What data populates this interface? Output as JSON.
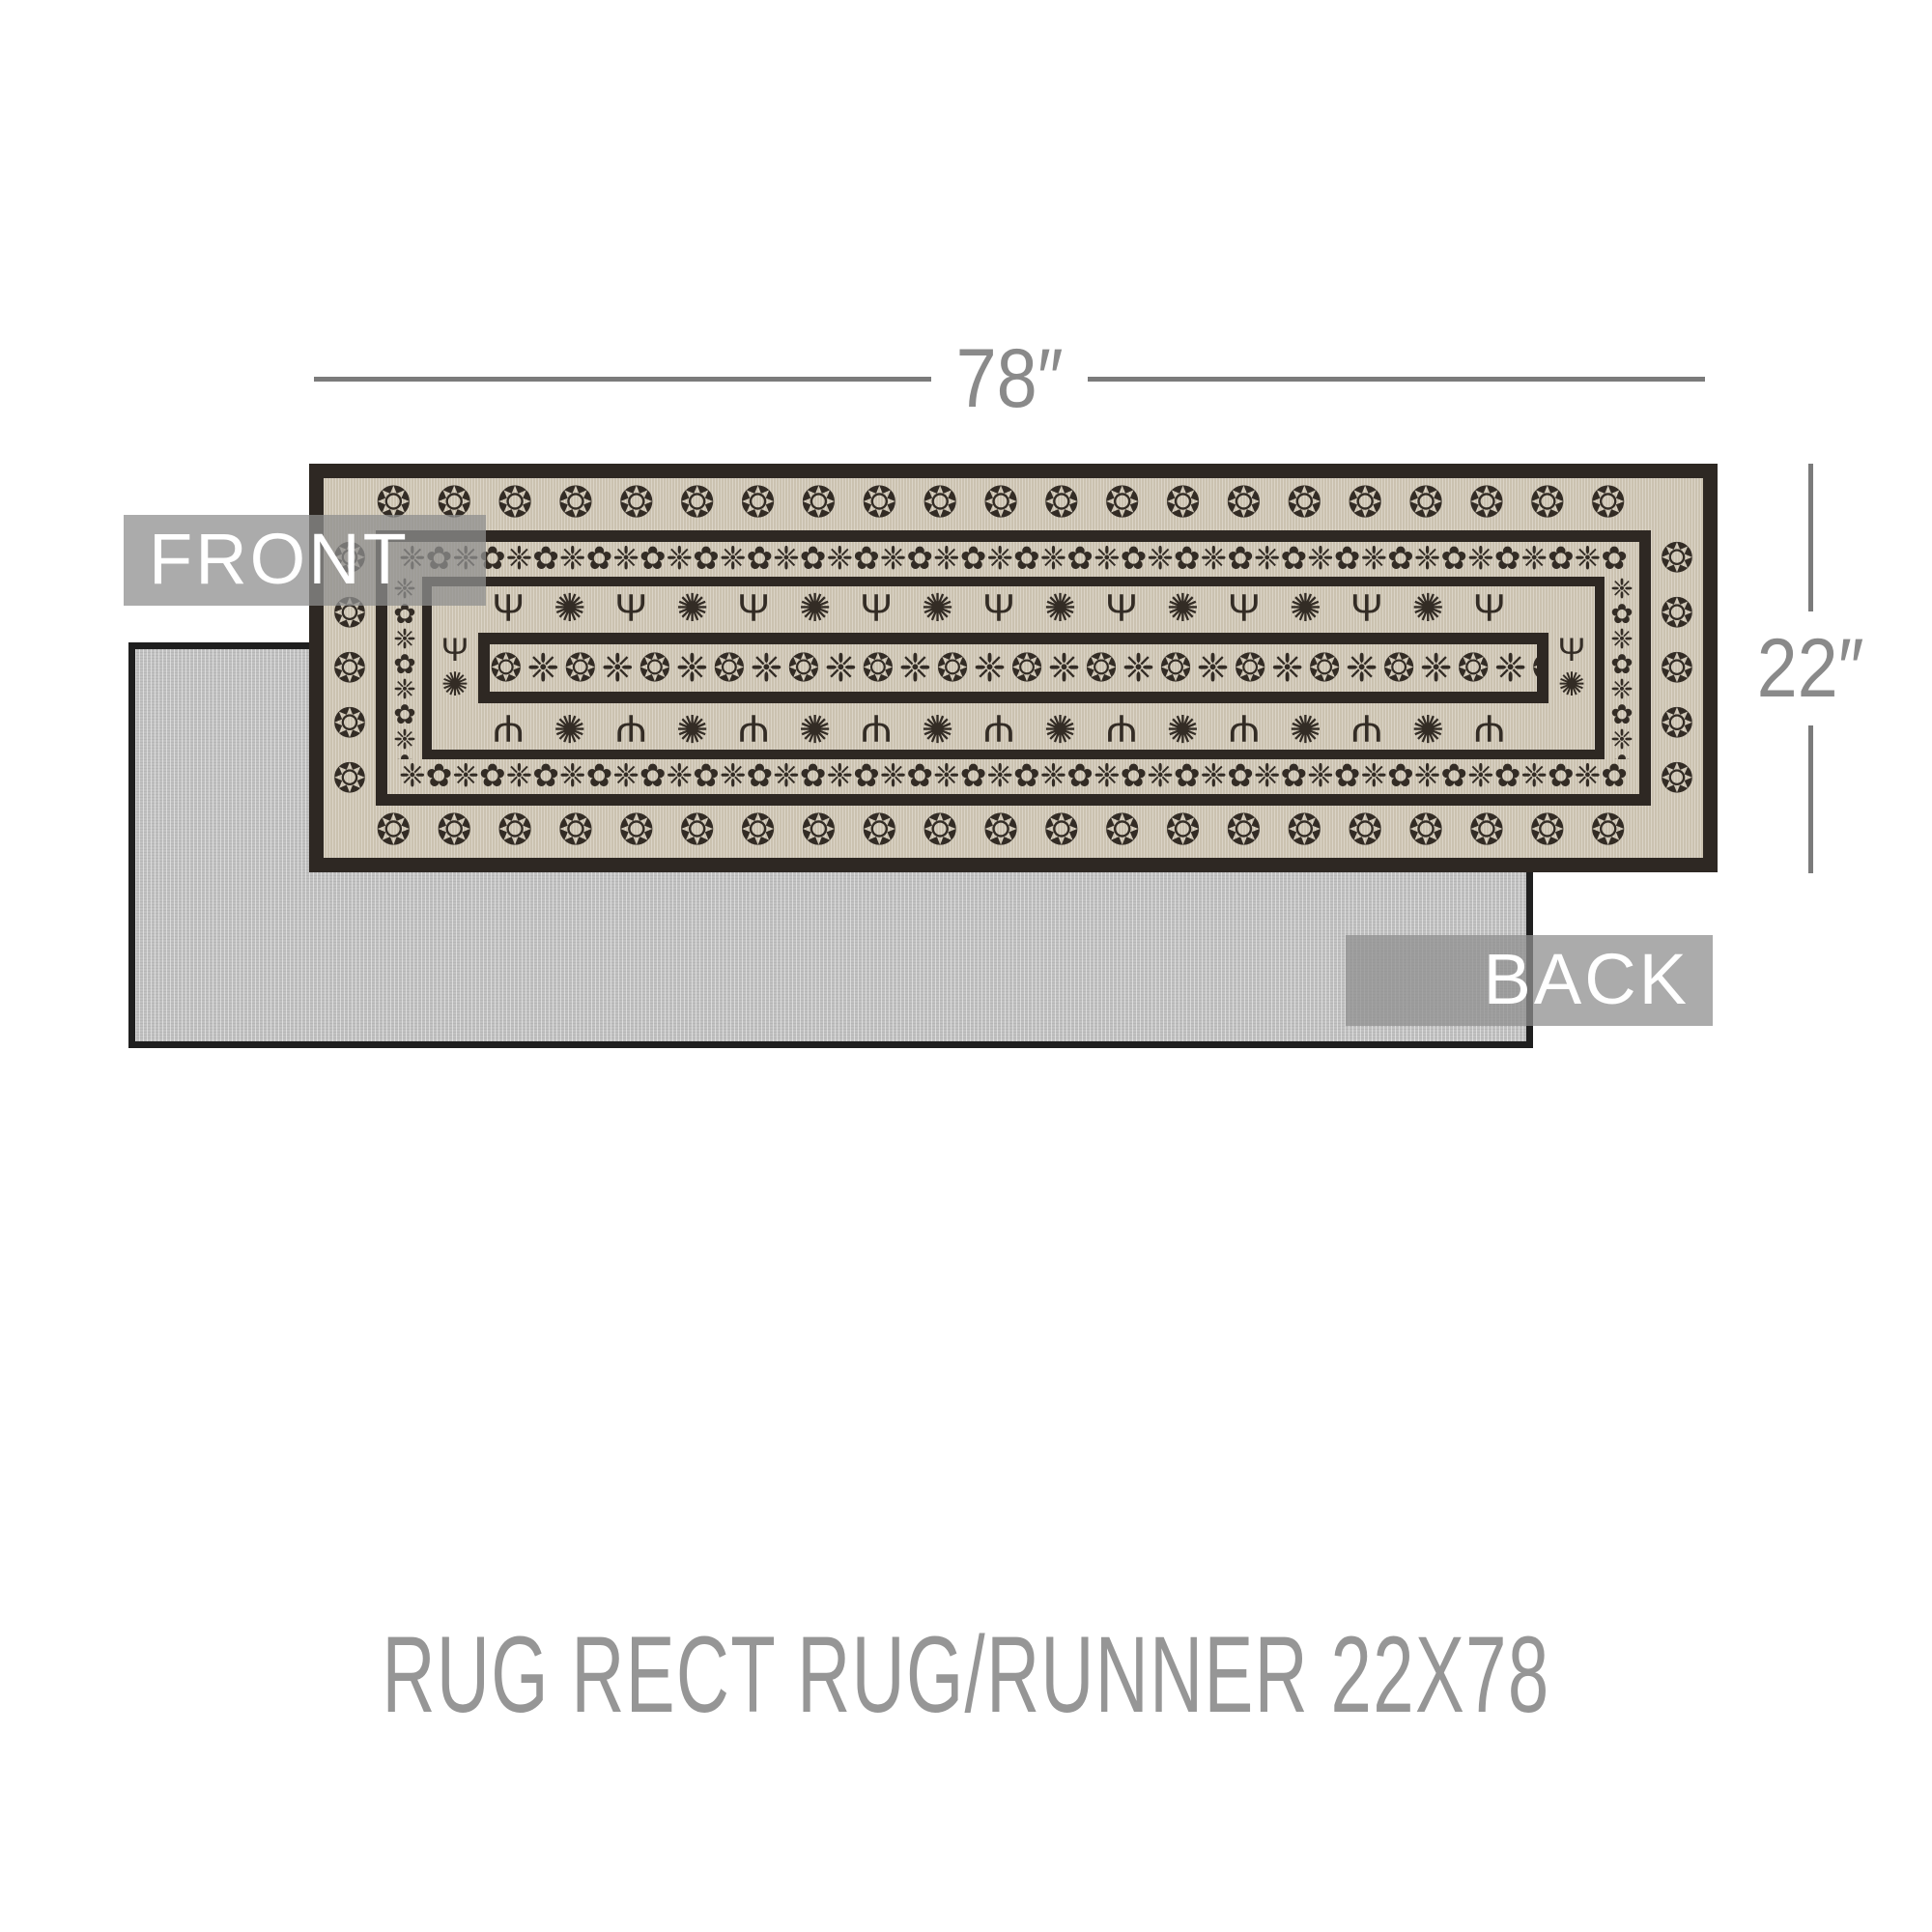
{
  "theme": {
    "line_color": "#7b7b7b",
    "dim_text_color": "#8a8a8a",
    "badge_bg": "rgba(143,143,143,0.75)",
    "badge_text": "#ffffff",
    "caption_color": "#969696",
    "rug_dark": "#2e2823",
    "rug_tan": "#cfc6b4",
    "rug_pattern": "#332c25",
    "back_fabric": "#c1c1c1",
    "back_border": "#1f1f1f"
  },
  "dimensions": {
    "width_label": "78″",
    "height_label": "22″"
  },
  "badges": {
    "front": "FRONT",
    "back": "BACK"
  },
  "caption": {
    "text": "RUG RECT RUG/RUNNER 22X78"
  },
  "patterns": {
    "medallion": "❂",
    "rosette": "✺",
    "candelabra": "Ψ",
    "lace": "❈",
    "floret": "✿"
  }
}
